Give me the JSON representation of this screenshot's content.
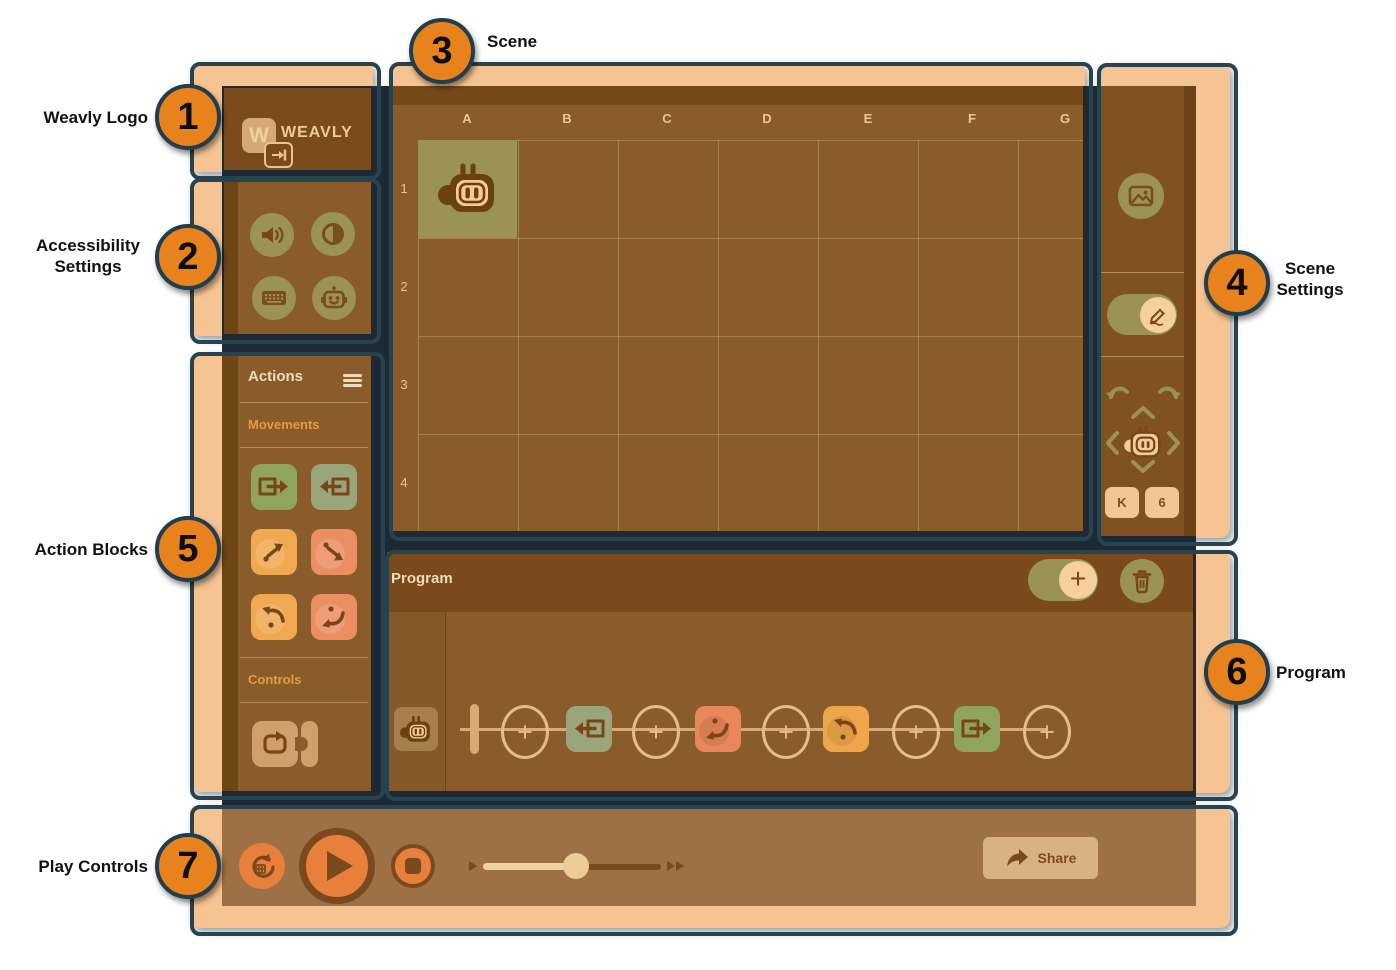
{
  "callouts": [
    {
      "number": "1",
      "label": "Weavly Logo"
    },
    {
      "number": "2",
      "label": "Accessibility Settings"
    },
    {
      "number": "3",
      "label": "Scene"
    },
    {
      "number": "4",
      "label": "Scene Settings"
    },
    {
      "number": "5",
      "label": "Action Blocks"
    },
    {
      "number": "6",
      "label": "Program"
    },
    {
      "number": "7",
      "label": "Play Controls"
    }
  ],
  "logo": {
    "letter": "W",
    "wordmark": "WEAVLY"
  },
  "accessibility": {
    "icons": [
      "volume",
      "contrast",
      "keyboard",
      "robot-face"
    ]
  },
  "actions": {
    "title": "Actions",
    "movements_label": "Movements",
    "controls_label": "Controls",
    "movement_blocks": [
      "forward",
      "backward",
      "turn-left-45",
      "turn-right-45",
      "turn-left-90",
      "turn-right-90"
    ],
    "control_blocks": [
      "loop"
    ]
  },
  "scene": {
    "columns": [
      "A",
      "B",
      "C",
      "D",
      "E",
      "F",
      "G"
    ],
    "rows": [
      "1",
      "2",
      "3",
      "4"
    ],
    "character": {
      "name": "robot",
      "cell": "A1"
    }
  },
  "scene_settings": {
    "buttons": [
      "scene-background",
      "pen-toggle",
      "undo",
      "redo",
      "move-up",
      "move-left",
      "move-right",
      "move-down"
    ],
    "key_button": "K",
    "count_button": "6"
  },
  "program": {
    "title": "Program",
    "plus": "+",
    "buttons": [
      "add-step-toggle",
      "delete-all"
    ],
    "steps": [
      "start",
      "backward",
      "turn-right-90",
      "turn-left-90",
      "forward"
    ]
  },
  "play": {
    "buttons": [
      "reset",
      "play",
      "stop"
    ],
    "slider": {
      "value_pct": 52,
      "min_icon": "slow",
      "max_icon": "fast"
    },
    "share_label": "Share"
  },
  "colors": {
    "card_peach": "#f6c493",
    "outline_navy": "#274350",
    "backdrop": "#1d2a33",
    "header_brown": "#7b4a1d",
    "panel_brown": "#8a5c2c",
    "olive": "#9b9257",
    "callout_orange": "#e8821c",
    "play_orange": "#e8803c",
    "block_green": "#8fa45e",
    "block_sage": "#9aa57c",
    "block_orange": "#f0a851",
    "block_salmon": "#eb8f63",
    "loop_tan": "#cfa06b",
    "glyph_brown": "#7a4617"
  }
}
